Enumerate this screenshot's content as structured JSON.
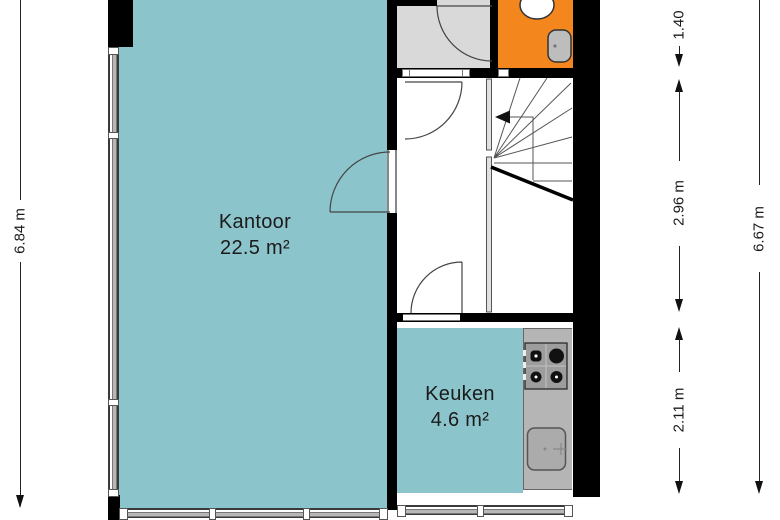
{
  "plan": {
    "title": "floor-plan",
    "rooms": [
      {
        "name": "Kantoor",
        "area": "22.5 m²"
      },
      {
        "name": "Keuken",
        "area": "4.6 m²"
      }
    ],
    "dimensions": {
      "left_total": "6.84 m",
      "right_total": "6.67 m",
      "right_segments": [
        "1.40",
        "2.96 m",
        "2.11 m"
      ]
    },
    "colors": {
      "room_fill": "#8cc4cb",
      "toilet_fill": "#f4861e",
      "hallway_fill": "#d9d9d9",
      "counter_fill": "#b5b5b5",
      "wall": "#000000",
      "dimension_text": "#1b1b1b"
    },
    "icons": {
      "toilet-icon": "white ellipse (top-view toilet)",
      "hand-basin-icon": "rounded grey rectangle on wall",
      "stove-icon": "4-burner hob panel",
      "kitchen-sink-icon": "rounded basin with faucet cross",
      "stairs-icon": "winder stairs with walk-line arrow",
      "door-arc-icon": "quarter-circle door swing"
    }
  }
}
